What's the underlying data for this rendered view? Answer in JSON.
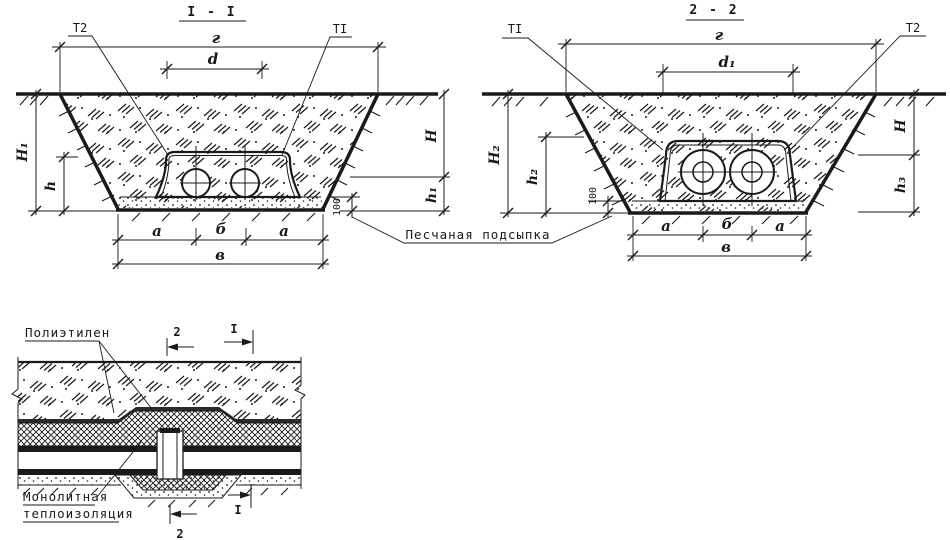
{
  "page": {
    "background": "#ffffff",
    "ink": "#1a1a1a"
  },
  "section_1": {
    "title": "I - I",
    "pipe_labels": {
      "left": "Т2",
      "right": "ТI"
    },
    "dims": {
      "top_width": "г",
      "pipe_spacing": "d",
      "depth_left_total": "H₁",
      "block_height": "h",
      "depth_right": "H",
      "depth_right_lower": "h₁",
      "sand_thickness": "100",
      "bottom_left": "а",
      "bottom_center": "б",
      "bottom_right": "а",
      "bottom_total": "в"
    }
  },
  "section_2": {
    "title": "2 - 2",
    "pipe_labels": {
      "left": "ТI",
      "right": "Т2"
    },
    "dims": {
      "top_width": "г",
      "pipe_spacing": "d₁",
      "depth_left_total": "H₂",
      "block_height": "h₂",
      "depth_right": "H",
      "depth_right_lower": "h₃",
      "sand_thickness": "100",
      "bottom_left": "а",
      "bottom_center": "б",
      "bottom_right": "а",
      "bottom_total": "в"
    }
  },
  "shared_labels": {
    "sand_bedding": "Песчаная подсыпка"
  },
  "detail": {
    "polyethylene": "Полиэтилен",
    "insulation_line1": "Монолитная",
    "insulation_line2": "теплоизоляция",
    "cut_marks": {
      "top_2": "2",
      "top_1": "I",
      "bottom_1": "I",
      "bottom_2": "2"
    }
  }
}
